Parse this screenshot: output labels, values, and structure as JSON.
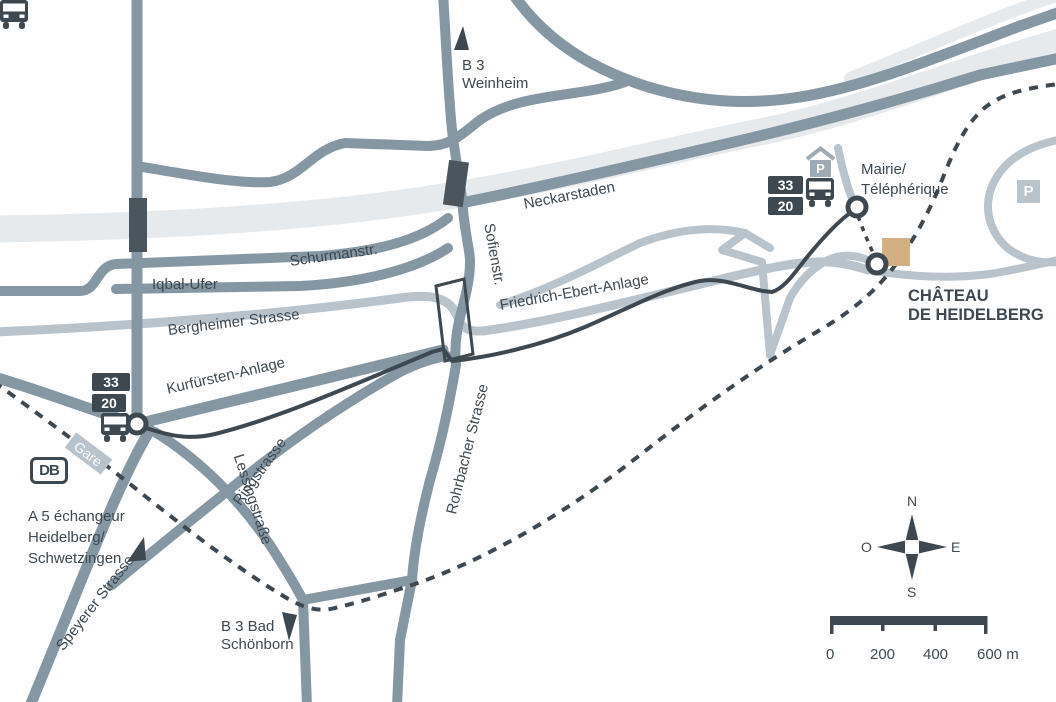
{
  "streets": {
    "iqbal_ufer": "Iqbal-Ufer",
    "schurmanstr": "Schurmanstr.",
    "bergheimer": "Bergheimer Strasse",
    "kurfuersten": "Kurfürsten-Anlage",
    "neckarstaden": "Neckarstaden",
    "sofienstr": "Sofienstr.",
    "friedrich_ebert": "Friedrich-Ebert-Anlage",
    "rohrbacher": "Rohrbacher Strasse",
    "ringstrasse": "Ringstrasse",
    "lessingstrasse": "Lessingstraße",
    "speyerer": "Speyerer Strasse"
  },
  "roadsigns": {
    "b3_north_line1": "B 3",
    "b3_north_line2": "Weinheim",
    "b3_south_line1": "B 3 Bad",
    "b3_south_line2": "Schönborn",
    "a5_line1": "A 5  échangeur",
    "a5_line2": "Heidelberg/",
    "a5_line3": "Schwetzingen"
  },
  "poi": {
    "mairie_line1": "Mairie/",
    "mairie_line2": "Téléphérique",
    "chateau_line1": "CHÂTEAU",
    "chateau_line2": "DE HEIDELBERG",
    "gare": "Gare",
    "db_logo": "DB",
    "parking": "P"
  },
  "bus": {
    "line_33": "33",
    "line_20": "20"
  },
  "compass": {
    "north": "N",
    "west": "O",
    "east": "E",
    "south": "S"
  },
  "scalebar": {
    "t0": "0",
    "t200": "200",
    "t400": "400",
    "t600": "600 m"
  },
  "colors": {
    "road": "#8697a4",
    "road_light": "#b9c3cb",
    "river": "#e7eaed",
    "dark": "#3d4850",
    "bridge": "#4a555d",
    "chateau": "#d2b083"
  }
}
